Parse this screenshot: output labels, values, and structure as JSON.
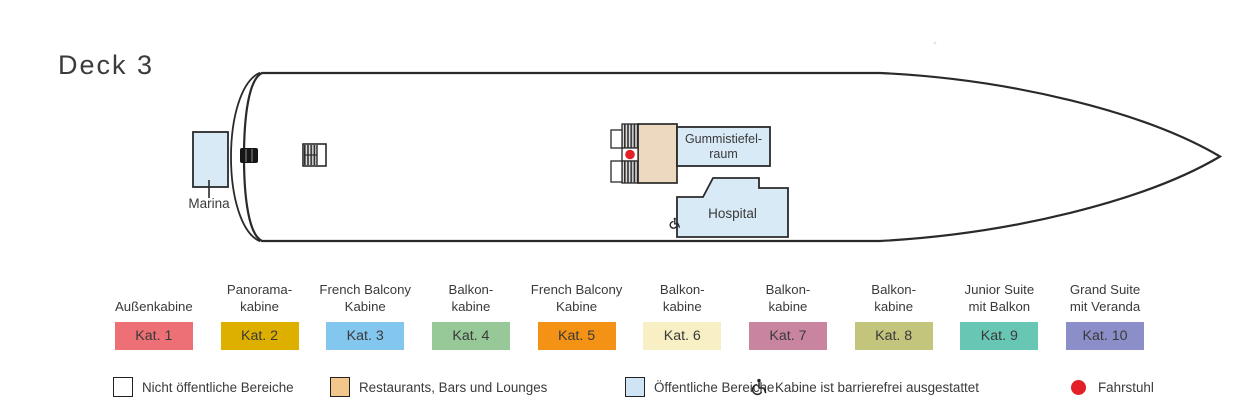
{
  "title": "Deck 3",
  "ship": {
    "marina_label": "Marina",
    "gummi_line1": "Gummistiefel-",
    "gummi_line2": "raum",
    "hospital_label": "Hospital"
  },
  "colors": {
    "room_blue": "#d9eaf7",
    "deck_tan": "#ecd9c0",
    "legend_tan": "#f3c78b",
    "legend_blue": "#cfe4f4",
    "red": "#e32028",
    "outline": "#2a2a2a",
    "text": "#3a3a3a"
  },
  "categories": [
    {
      "label": "Außenkabine",
      "kat": "Kat. 1",
      "color": "#ee7077"
    },
    {
      "label": "Panorama-\nkabine",
      "kat": "Kat. 2",
      "color": "#ddb000"
    },
    {
      "label": "French Balcony\nKabine",
      "kat": "Kat. 3",
      "color": "#83c7ee"
    },
    {
      "label": "Balkon-\nkabine",
      "kat": "Kat. 4",
      "color": "#97c897"
    },
    {
      "label": "French Balcony\nKabine",
      "kat": "Kat. 5",
      "color": "#f39214"
    },
    {
      "label": "Balkon-\nkabine",
      "kat": "Kat. 6",
      "color": "#f8efc5"
    },
    {
      "label": "Balkon-\nkabine",
      "kat": "Kat. 7",
      "color": "#c985a0"
    },
    {
      "label": "Balkon-\nkabine",
      "kat": "Kat. 8",
      "color": "#c4c57d"
    },
    {
      "label": "Junior Suite\nmit Balkon",
      "kat": "Kat. 9",
      "color": "#67c6b4"
    },
    {
      "label": "Grand Suite\nmit Veranda",
      "kat": "Kat. 10",
      "color": "#8c8ec9"
    }
  ],
  "legend": [
    {
      "label": "Nicht öffentliche Bereiche"
    },
    {
      "label": "Restaurants, Bars und Lounges"
    },
    {
      "label": "Öffentliche Bereiche"
    },
    {
      "label": "Kabine ist barrierefrei ausgestattet"
    },
    {
      "label": "Fahrstuhl"
    }
  ]
}
